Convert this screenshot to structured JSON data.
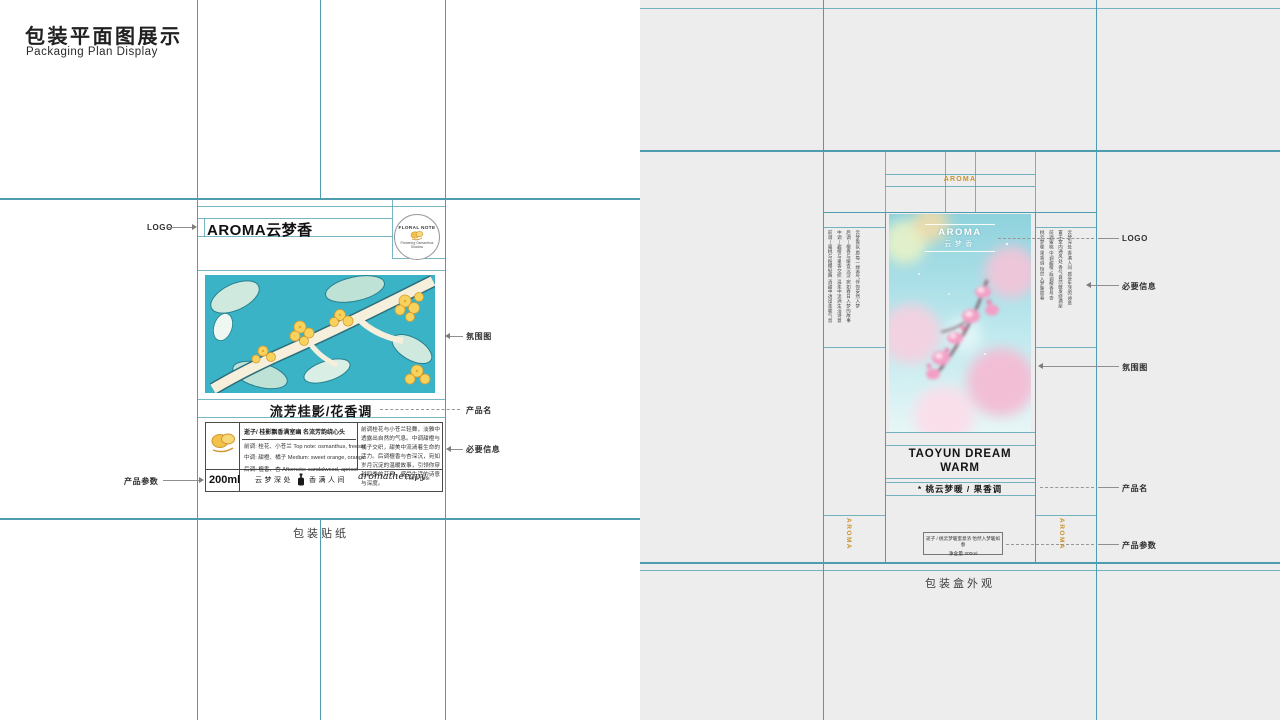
{
  "page": {
    "title_cn": "包装平面图展示",
    "title_en": "Packaging Plan Display"
  },
  "labels": {
    "logo": "LOGO",
    "atmosphere": "氛围图",
    "product_name": "产品名",
    "required_info": "必要信息",
    "product_params": "产品参数"
  },
  "sticker": {
    "caption": "包装贴纸",
    "logo_text": "AROMA云梦香",
    "badge_top": "FLORAL NOTE",
    "badge_bottom": "Flowering Osmanthus Shadow",
    "product_name": "流芳桂影/花香调",
    "tagline": "逝子/ 桂影飘香满室幽  名流芳韵绕心头",
    "note_top": "前调: 桂花、小苍兰 Top note: osmanthus, freesia",
    "note_mid": "中调: 甜橙、橘子 Medium: sweet orange, orange",
    "note_base": "后调: 檀香、杏 Afternote: sandalwood, apricot",
    "description": "前调桂花与小苍兰轻舞，淡雅中透露出自然的气息。中调甜橙与橘子交织，甜美中流淌着生命的活力。后调檀香与杏深沉，宛如岁月沉淀的温暖故事，引领你穿越四季的芬芳，感受生活的诗意与深度。",
    "volume": "200ml",
    "slogan_left": "云梦深处",
    "slogan_right": "香满人间",
    "script_text": "aromatherapy",
    "note_tag": "Floral note"
  },
  "box": {
    "caption": "包装盒外观",
    "flap_logo": "AROMA",
    "front_logo1": "AROMA",
    "front_logo2": "云梦香",
    "name_line1": "TAOYUN DREAM",
    "name_line2": "WARM",
    "name_cn": "* 桃云梦暖 / 果香调",
    "tagline": "逝子 / 桃云梦暖蜜意浓  怡然入梦暖如春",
    "volume": "净含量 200ml",
    "side_logo": "AROMA",
    "left_flap_cols": [
      "前调—蜜桃与粉樱轻舞 清甜中透出柔暖气息",
      "中调—甜橙与果香交织 温柔中流淌生活诗意",
      "后调—檀香与暖杏沉淀 宛如春日入梦的故事",
      "云梦香氛 愿每一缕香气伴你安然入梦"
    ],
    "right_flap_cols": [
      "桃云梦暖 果香调 怡然入梦暖如春",
      "前调蜜桃 中调甜橙 后调檀香与杏",
      "置于室内通风处 香气自然散发绕满屋",
      "云梦深处 香满人间 感受生活的诗意"
    ]
  },
  "colors": {
    "guide": "#4d9cb0",
    "gold": "#c9932e",
    "label": "#2f2f2f",
    "sticker_teal": "#3bb3c6"
  }
}
